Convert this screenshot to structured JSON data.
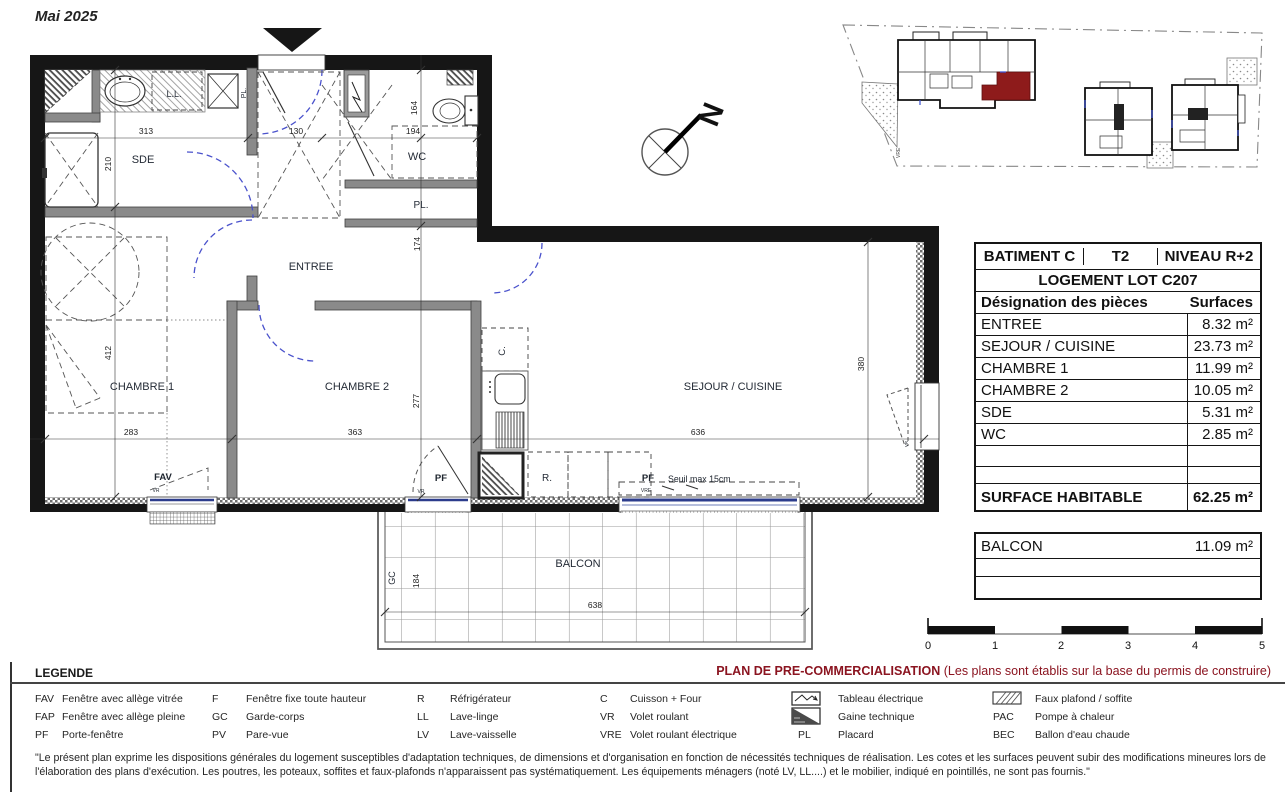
{
  "header": {
    "date": "Mai 2025"
  },
  "colors": {
    "accent_red": "#8b1420",
    "highlight_unit_red": "#8e1b1b",
    "door_arc_blue": "#4a52cc",
    "glazing_blue": "#2c3c8c"
  },
  "plan": {
    "rooms": {
      "sde": "SDE",
      "wc": "WC",
      "pl_wc": "PL.",
      "pl_sde": "PL.",
      "entree": "ENTREE",
      "ch1": "CHAMBRE 1",
      "ch2": "CHAMBRE 2",
      "sejour": "SEJOUR / CUISINE",
      "balcon": "BALCON"
    },
    "labels": {
      "ll": "L.L.",
      "c": "C.",
      "r": "R.",
      "gc": "GC"
    },
    "dims": {
      "d313": "313",
      "d130": "130",
      "d194": "194",
      "d164": "164",
      "d210": "210",
      "d412": "412",
      "d174": "174",
      "d277": "277",
      "d283": "283",
      "d363": "363",
      "d636": "636",
      "d380": "380",
      "d184": "184",
      "d638": "638"
    },
    "annotations": {
      "fav": "FAV",
      "vr1": "VR",
      "vr2": "VR",
      "vr3": "VR",
      "pf1": "PF",
      "pf2": "PF",
      "vre": "VRE",
      "seuil": "Seuil max 15cm",
      "north": "N",
      "site_vre": "VRE"
    }
  },
  "table": {
    "header": {
      "batiment": "BATIMENT  C",
      "type": "T2",
      "niveau": "NIVEAU  R+2"
    },
    "lot": "LOGEMENT LOT C207",
    "columns": {
      "designation": "Désignation des pièces",
      "surfaces": "Surfaces"
    },
    "rows": [
      {
        "label": "ENTREE",
        "value": "8.32 m²"
      },
      {
        "label": "SEJOUR / CUISINE",
        "value": "23.73 m²"
      },
      {
        "label": "CHAMBRE 1",
        "value": "11.99 m²"
      },
      {
        "label": "CHAMBRE 2",
        "value": "10.05 m²"
      },
      {
        "label": "SDE",
        "value": "5.31 m²"
      },
      {
        "label": "WC",
        "value": "2.85 m²"
      }
    ],
    "total": {
      "label": "SURFACE HABITABLE",
      "value": "62.25 m²"
    },
    "balcon": {
      "label": "BALCON",
      "value": "11.09 m²"
    }
  },
  "scalebar": {
    "labels": [
      "0",
      "1",
      "2",
      "3",
      "4",
      "5"
    ]
  },
  "legend": {
    "title": "LEGENDE",
    "plan_type": "PLAN DE PRE-COMMERCIALISATION",
    "plan_type_note": "(Les plans sont établis sur la base du permis de construire)",
    "items": [
      {
        "abbr": "FAV",
        "label": "Fenêtre avec allège vitrée"
      },
      {
        "abbr": "FAP",
        "label": "Fenêtre avec allège pleine"
      },
      {
        "abbr": "PF",
        "label": "Porte-fenêtre"
      },
      {
        "abbr": "F",
        "label": "Fenêtre fixe toute hauteur"
      },
      {
        "abbr": "GC",
        "label": "Garde-corps"
      },
      {
        "abbr": "PV",
        "label": "Pare-vue"
      },
      {
        "abbr": "R",
        "label": "Réfrigérateur"
      },
      {
        "abbr": "LL",
        "label": "Lave-linge"
      },
      {
        "abbr": "LV",
        "label": "Lave-vaisselle"
      },
      {
        "abbr": "C",
        "label": "Cuisson + Four"
      },
      {
        "abbr": "VR",
        "label": "Volet roulant"
      },
      {
        "abbr": "VRE",
        "label": "Volet roulant électrique"
      },
      {
        "abbr": "",
        "icon": "tableau-electrique-icon",
        "label": "Tableau électrique"
      },
      {
        "abbr": "",
        "icon": "gaine-technique-icon",
        "label": "Gaine technique"
      },
      {
        "abbr": "PL",
        "label": "Placard"
      },
      {
        "abbr": "",
        "icon": "faux-plafond-icon",
        "label": "Faux plafond / soffite"
      },
      {
        "abbr": "PAC",
        "label": "Pompe à chaleur"
      },
      {
        "abbr": "BEC",
        "label": "Ballon d'eau chaude"
      }
    ]
  },
  "disclaimer": "\"Le présent plan exprime les dispositions générales du logement susceptibles d'adaptation techniques, de dimensions et d'organisation en fonction de nécessités techniques de réalisation. Les cotes et les surfaces peuvent subir des modifications mineures lors de l'élaboration des plans d'exécution. Les poutres, les poteaux, soffites et faux-plafonds n'apparaissent pas systématiquement. Les équipements ménagers (noté LV, LL....) et le mobilier, indiqué en pointillés, ne sont pas fournis.\""
}
